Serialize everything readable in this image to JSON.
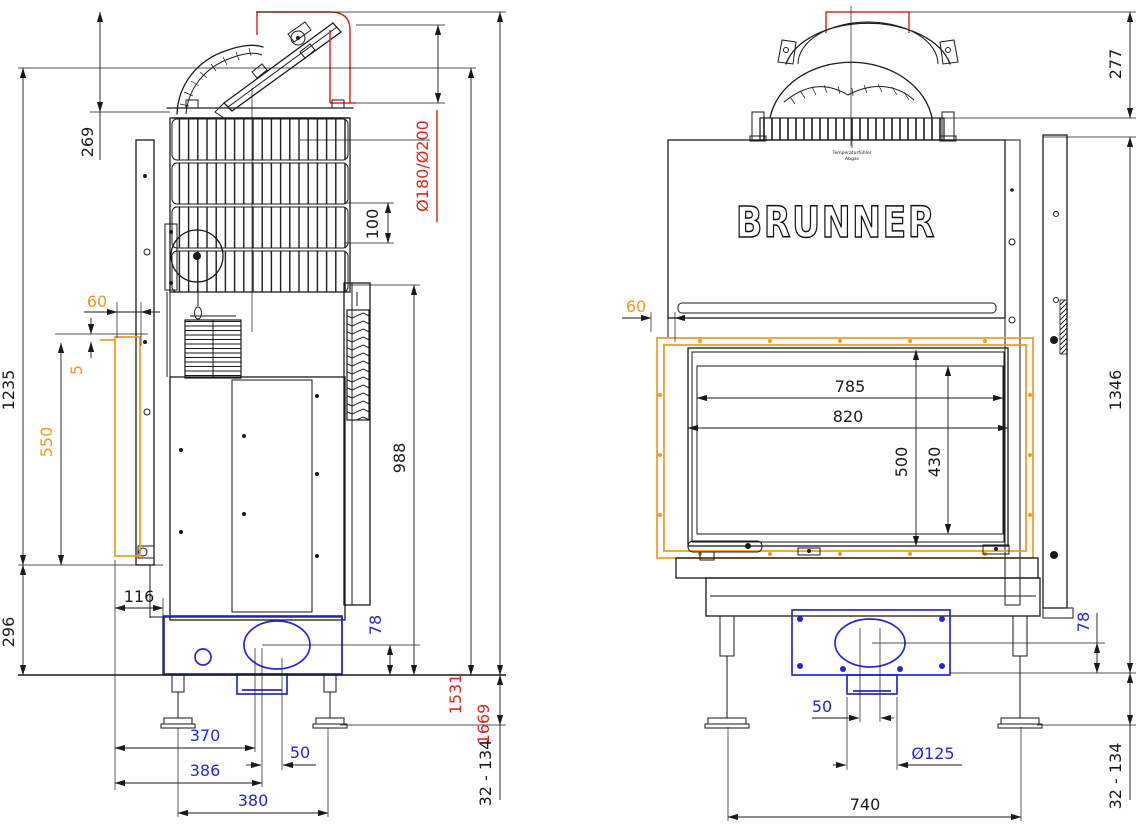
{
  "drawing": {
    "brand": "BRUNNER",
    "note1": "Temperaturfühler",
    "note2": "Abgas",
    "colors": {
      "line_black": "#1a1a1a",
      "accent_orange": "#f09a20",
      "accent_red": "#e02820",
      "accent_blue": "#2626d8"
    },
    "labels": {
      "side": {
        "d269": "269",
        "d1235": "1235",
        "d296": "296",
        "d550": "550",
        "d5": "5",
        "d60": "60",
        "d116": "116",
        "d100": "100",
        "flue": "Ø180/Ø200",
        "d988": "988",
        "d1531": "1531",
        "d1669": "1669",
        "d78": "78",
        "d370": "370",
        "d386": "386",
        "d50": "50",
        "d380": "380",
        "range": "32 - 134"
      },
      "front": {
        "d277": "277",
        "d60": "60",
        "d785": "785",
        "d820": "820",
        "d500": "500",
        "d430": "430",
        "d1346": "1346",
        "d78": "78",
        "d50": "50",
        "d125": "Ø125",
        "d740": "740",
        "range": "32 - 134"
      }
    }
  }
}
